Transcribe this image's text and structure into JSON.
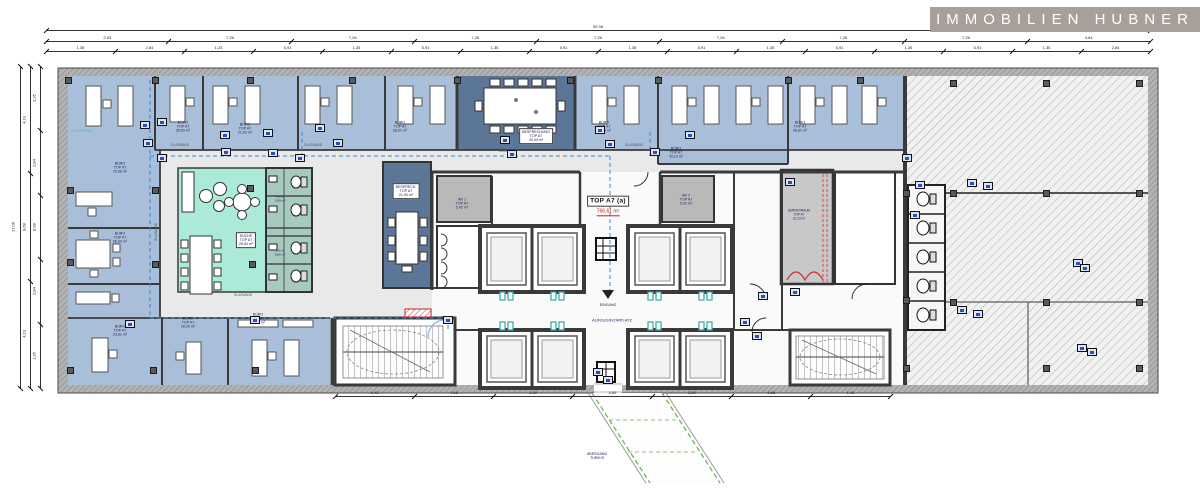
{
  "meta": {
    "width": 1200,
    "height": 490,
    "bg": "#ffffff"
  },
  "logo": {
    "text": "IMMOBILIEN HUBNER",
    "bg": "#a7a098",
    "fg": "#ffffff",
    "x": 930,
    "y": 7,
    "w": 270,
    "h": 25
  },
  "plan": {
    "title": "TOP A7 (a)",
    "area_red": "766,61 m²",
    "colors": {
      "office": "#a9bed9",
      "meeting": "#5c7698",
      "kitchen": "#abead8",
      "wc": "#a6cabf",
      "corridor": "#e9e9e9",
      "core": "#fafafa",
      "gray_room": "#b9b9b9",
      "server": "#c8c8c8",
      "wall": "#3a3a3a",
      "accent": "#2b4fc2",
      "escape": "#3a86d6",
      "red": "#cc2222",
      "walkway": "#6ab54e",
      "teal": "#2fa8a4"
    },
    "labels": [
      {
        "name": "room-label-buero-1",
        "lines": [
          "BÜRO",
          "TOP A7",
          "35,54 m²"
        ],
        "x": 183,
        "y": 127
      },
      {
        "name": "room-label-buero-2",
        "lines": [
          "BÜRO",
          "TOP A7",
          "21,92 m²"
        ],
        "x": 245,
        "y": 129
      },
      {
        "name": "room-label-buero-3",
        "lines": [
          "BÜRO",
          "TOP A7",
          "28,01 m²"
        ],
        "x": 400,
        "y": 127
      },
      {
        "name": "room-label-buero-4",
        "lines": [
          "BÜRO",
          "TOP A7",
          "25,56 m²"
        ],
        "x": 604,
        "y": 127
      },
      {
        "name": "room-label-buero-5",
        "lines": [
          "BÜRO",
          "TOP A7",
          "43,13 m²"
        ],
        "x": 676,
        "y": 153
      },
      {
        "name": "room-label-buero-6",
        "lines": [
          "BÜRO",
          "TOP A7",
          "36,61 m²"
        ],
        "x": 800,
        "y": 127
      },
      {
        "name": "room-label-buero-7",
        "lines": [
          "BÜRO",
          "TOP A7",
          "20,96 m²"
        ],
        "x": 120,
        "y": 168
      },
      {
        "name": "room-label-buero-8",
        "lines": [
          "BÜRO",
          "TOP A7",
          "26,34 m²"
        ],
        "x": 120,
        "y": 238
      },
      {
        "name": "room-label-buero-9",
        "lines": [
          "BÜRO",
          "TOP A7",
          "23,61 m²"
        ],
        "x": 120,
        "y": 331
      },
      {
        "name": "room-label-buero-10",
        "lines": [
          "BÜRO",
          "TOP A7",
          "18,26 m²"
        ],
        "x": 188,
        "y": 323
      },
      {
        "name": "room-label-buero-11",
        "lines": [
          "BÜRO",
          "TOP A7",
          "29,05 m²"
        ],
        "x": 258,
        "y": 319
      },
      {
        "name": "room-label-besprechung",
        "lines": [
          "BESPRECHUNG",
          "TOP A7",
          "40,04 m²"
        ],
        "x": 536,
        "y": 136,
        "box": true
      },
      {
        "name": "room-label-besprech-2",
        "lines": [
          "BESPRECH.",
          "TOP A7",
          "21,90 m²"
        ],
        "x": 406,
        "y": 191,
        "box": true
      },
      {
        "name": "room-label-kueche",
        "lines": [
          "KÜCHE",
          "TOP A7",
          "28,84 m²"
        ],
        "x": 246,
        "y": 240,
        "box": true
      },
      {
        "name": "room-label-ar-1",
        "lines": [
          "AR 1",
          "TOP A7",
          "5,42 m²"
        ],
        "x": 462,
        "y": 204
      },
      {
        "name": "room-label-ar-2",
        "lines": [
          "AR 2",
          "TOP A7",
          "5,42 m²"
        ],
        "x": 686,
        "y": 200
      },
      {
        "name": "room-label-serverraum",
        "lines": [
          "SERVERRAUM",
          "TOP A7",
          "10,23 m²"
        ],
        "x": 799,
        "y": 215,
        "s": 3.2
      },
      {
        "name": "label-glaswand-1",
        "lines": [
          "GLASWAND"
        ],
        "x": 180,
        "y": 146,
        "s": 3.2,
        "c": "#555555"
      },
      {
        "name": "label-glaswand-2",
        "lines": [
          "GLASWAND"
        ],
        "x": 313,
        "y": 146,
        "s": 3.2,
        "c": "#555555"
      },
      {
        "name": "label-glaswand-3",
        "lines": [
          "GLASWAND"
        ],
        "x": 508,
        "y": 152,
        "s": 3.2,
        "c": "#555555"
      },
      {
        "name": "label-glaswand-4",
        "lines": [
          "GLASWAND"
        ],
        "x": 634,
        "y": 146,
        "s": 3.2,
        "c": "#555555"
      },
      {
        "name": "label-glaswand-5",
        "lines": [
          "GLASWAND"
        ],
        "x": 243,
        "y": 296,
        "s": 3.2,
        "c": "#555555"
      },
      {
        "name": "label-glaswand-6",
        "lines": [
          "GLASWAND"
        ],
        "x": 157,
        "y": 232,
        "s": 3.2,
        "c": "#555555",
        "rot": -90
      },
      {
        "name": "label-fluchtweg",
        "lines": [
          "FLUCHTWEG"
        ],
        "x": 82,
        "y": 131,
        "s": 3.4,
        "c": "#3fb4e0"
      },
      {
        "name": "label-wc-d",
        "lines": [
          "WC-D",
          "5,80 m²"
        ],
        "x": 280,
        "y": 199,
        "s": 3
      },
      {
        "name": "label-wc-h",
        "lines": [
          "WC-H",
          "5,80 m²"
        ],
        "x": 280,
        "y": 253,
        "s": 3
      },
      {
        "name": "unit-title",
        "lines": [
          "TOP A7 (a)"
        ],
        "x": 608,
        "y": 201,
        "s": 6.5,
        "box": true,
        "bold": true
      },
      {
        "name": "unit-area-red",
        "lines": [
          "766,61 m²"
        ],
        "x": 608,
        "y": 213,
        "s": 5,
        "redu": true
      },
      {
        "name": "label-eingang",
        "lines": [
          "EINGANG"
        ],
        "x": 608,
        "y": 305,
        "s": 3.6
      },
      {
        "name": "label-aufzugsvorplatz",
        "lines": [
          "AUFZUGSVORPLATZ"
        ],
        "x": 612,
        "y": 321,
        "s": 4
      },
      {
        "name": "label-uebergang-turm-b",
        "lines": [
          "ÜBERGANG",
          "TURM B"
        ],
        "x": 597,
        "y": 456,
        "s": 3.6
      }
    ],
    "dim_rows": [
      {
        "name": "dim-top-overall",
        "dir": "h",
        "pos": 30,
        "a": 46,
        "b": 1150,
        "values": [
          "59,38"
        ]
      },
      {
        "name": "dim-top-main",
        "dir": "h",
        "pos": 41,
        "a": 46,
        "b": 1150,
        "values": [
          "2,93",
          "7,26",
          "7,26",
          "7,26",
          "7,26",
          "7,26",
          "7,26",
          "7,26",
          "4,84"
        ]
      },
      {
        "name": "dim-top-detail",
        "dir": "h",
        "pos": 51,
        "a": 46,
        "b": 1150,
        "values": [
          "1,35",
          "2,84",
          "1,23",
          "5,91",
          "1,35",
          "5,91",
          "1,35",
          "5,91",
          "1,35",
          "5,91",
          "1,35",
          "5,91",
          "1,35",
          "5,91",
          "1,35",
          "2,84"
        ]
      },
      {
        "name": "dim-left-overall",
        "dir": "v",
        "pos": 20,
        "a": 66,
        "b": 388,
        "values": [
          "17,06"
        ]
      },
      {
        "name": "dim-left-main",
        "dir": "v",
        "pos": 30,
        "a": 66,
        "b": 388,
        "values": [
          "4,19",
          "8,68",
          "4,19"
        ]
      },
      {
        "name": "dim-left-detail",
        "dir": "v",
        "pos": 40,
        "a": 66,
        "b": 388,
        "values": [
          "1,35",
          "2,84",
          "8,68",
          "2,84",
          "1,35"
        ]
      },
      {
        "name": "dim-bottom",
        "dir": "h",
        "pos": 396,
        "a": 335,
        "b": 890,
        "values": [
          "1,43",
          "4,65",
          "1,20",
          "4,65",
          "1,20",
          "4,65",
          "1,43"
        ]
      }
    ],
    "columns": [
      [
        68,
        80
      ],
      [
        155,
        80
      ],
      [
        250,
        80
      ],
      [
        352,
        80
      ],
      [
        457,
        80
      ],
      [
        570,
        80
      ],
      [
        658,
        80
      ],
      [
        788,
        80
      ],
      [
        860,
        80
      ],
      [
        953,
        83
      ],
      [
        1046,
        83
      ],
      [
        1139,
        83
      ],
      [
        70,
        190
      ],
      [
        155,
        190
      ],
      [
        250,
        188
      ],
      [
        906,
        193
      ],
      [
        953,
        193
      ],
      [
        1046,
        193
      ],
      [
        1139,
        193
      ],
      [
        70,
        262
      ],
      [
        155,
        264
      ],
      [
        252,
        264
      ],
      [
        906,
        300
      ],
      [
        953,
        302
      ],
      [
        1046,
        302
      ],
      [
        1139,
        302
      ],
      [
        70,
        370
      ],
      [
        153,
        370
      ],
      [
        255,
        370
      ],
      [
        906,
        368
      ],
      [
        1046,
        368
      ],
      [
        1139,
        368
      ]
    ],
    "symbols": [
      [
        268,
        133
      ],
      [
        320,
        128
      ],
      [
        338,
        143
      ],
      [
        273,
        153
      ],
      [
        300,
        158
      ],
      [
        145,
        125
      ],
      [
        162,
        122
      ],
      [
        148,
        143
      ],
      [
        162,
        158
      ],
      [
        225,
        135
      ],
      [
        226,
        152
      ],
      [
        505,
        140
      ],
      [
        512,
        154
      ],
      [
        600,
        130
      ],
      [
        610,
        144
      ],
      [
        655,
        152
      ],
      [
        690,
        135
      ],
      [
        790,
        182
      ],
      [
        907,
        158
      ],
      [
        920,
        185
      ],
      [
        915,
        215
      ],
      [
        795,
        292
      ],
      [
        763,
        296
      ],
      [
        745,
        322
      ],
      [
        757,
        336
      ],
      [
        972,
        183
      ],
      [
        988,
        186
      ],
      [
        962,
        310
      ],
      [
        978,
        314
      ],
      [
        1078,
        263
      ],
      [
        1085,
        268
      ],
      [
        1082,
        348
      ],
      [
        1092,
        352
      ],
      [
        598,
        372
      ],
      [
        608,
        380
      ],
      [
        448,
        320
      ],
      [
        130,
        324
      ],
      [
        255,
        320
      ]
    ]
  }
}
